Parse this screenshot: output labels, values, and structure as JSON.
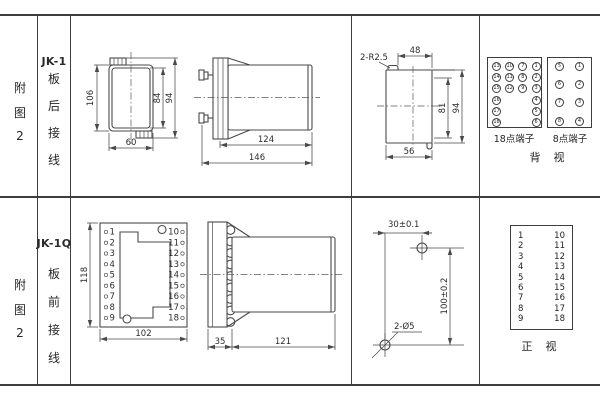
{
  "row1": {
    "fig_chars": [
      "附",
      "图",
      "2"
    ],
    "model": "JK-1",
    "wiring_chars": [
      "板",
      "后",
      "接",
      "线"
    ],
    "rear_view": {
      "dim_height": "106",
      "dim_inner_height": "84",
      "dim_outer_height": "94",
      "dim_width": "60"
    },
    "side_view": {
      "dim_body": "124",
      "dim_total": "146"
    },
    "cutout_view": {
      "corner_label": "2-R2.5",
      "dim_top": "48",
      "dim_inner_height": "81",
      "dim_height": "94",
      "dim_width": "56"
    },
    "terminal18": {
      "label": "18点端子",
      "rows": [
        [
          "13",
          "10",
          "7",
          "1"
        ],
        [
          "14",
          "11",
          "8",
          "2"
        ],
        [
          "15",
          "12",
          "9",
          "3"
        ],
        [
          "16",
          "",
          "",
          "4"
        ],
        [
          "17",
          "",
          "",
          "5"
        ],
        [
          "18",
          "",
          "",
          "6"
        ]
      ]
    },
    "terminal8": {
      "label": "8点端子",
      "rows": [
        [
          "5",
          "1"
        ],
        [
          "6",
          "2"
        ],
        [
          "7",
          "3"
        ],
        [
          "8",
          "4"
        ]
      ]
    },
    "view_caption": "背  视"
  },
  "row2": {
    "fig_chars": [
      "附",
      "图",
      "2"
    ],
    "model": "JK-1Q",
    "wiring_chars": [
      "板",
      "前",
      "接",
      "线"
    ],
    "front_view": {
      "dim_height": "118",
      "dim_width": "102",
      "left_terminals": [
        "1",
        "2",
        "3",
        "4",
        "5",
        "6",
        "7",
        "8",
        "9"
      ],
      "right_terminals": [
        "10",
        "11",
        "12",
        "13",
        "14",
        "15",
        "16",
        "17",
        "18"
      ]
    },
    "side_view": {
      "dim_plate": "35",
      "dim_body": "121"
    },
    "drill_view": {
      "dim_horizontal": "30±0.1",
      "dim_vertical": "100±0.2",
      "hole_label": "2-Ø5"
    },
    "terminal_table": {
      "left": [
        "1",
        "2",
        "3",
        "4",
        "5",
        "6",
        "7",
        "8",
        "9"
      ],
      "right": [
        "10",
        "11",
        "12",
        "13",
        "14",
        "15",
        "16",
        "17",
        "18"
      ]
    },
    "view_caption": "正  视"
  }
}
